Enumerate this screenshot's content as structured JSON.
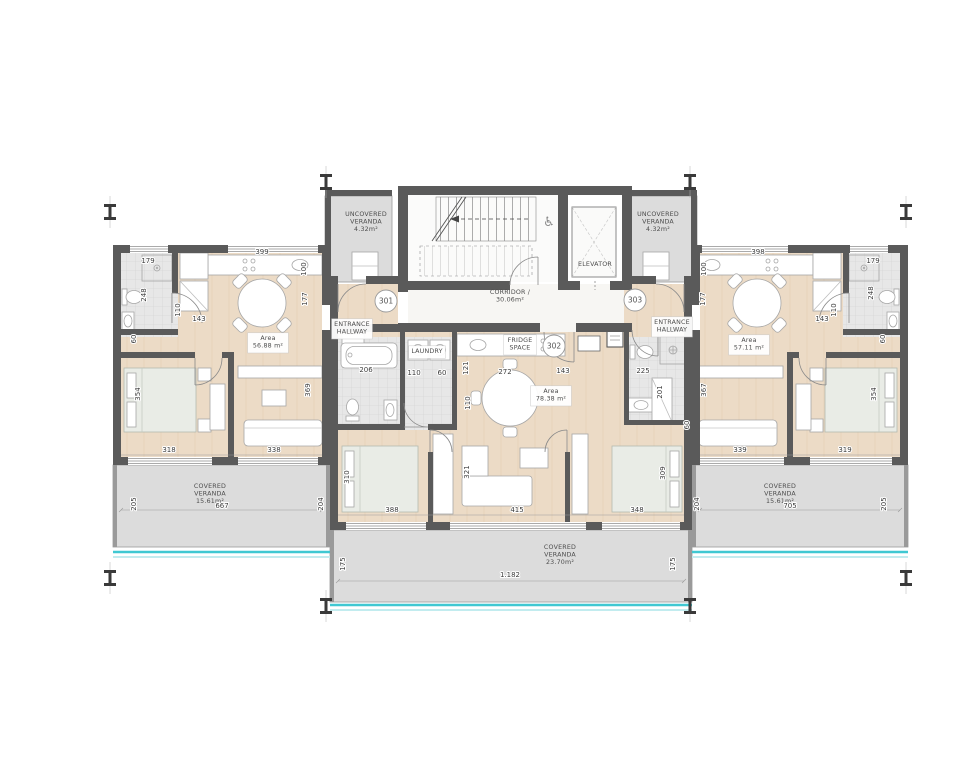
{
  "plan": {
    "drawing": "apartment-floor-plan",
    "icons": {
      "wheelchair": "♿"
    },
    "colors": {
      "wall": "#5a5a5a",
      "wood_floor": "#ecdbc6",
      "tile": "#e8e8e8",
      "veranda_slab": "#dcdcdc",
      "pool_edge_teal": "#3fc8d2",
      "pool_edge_light": "#c2ecef",
      "bed": "#e9ece6",
      "furniture": "#ffffff"
    },
    "units": [
      {
        "number": "301",
        "x": 386,
        "y": 301
      },
      {
        "number": "302",
        "x": 554,
        "y": 346
      },
      {
        "number": "303",
        "x": 635,
        "y": 300
      }
    ],
    "rooms": [
      {
        "name": "uncovered-veranda-left",
        "lines": [
          "UNCOVERED",
          "VERANDA",
          "4.32m²"
        ],
        "x": 366,
        "y": 216
      },
      {
        "name": "uncovered-veranda-right",
        "lines": [
          "UNCOVERED",
          "VERANDA",
          "4.32m²"
        ],
        "x": 658,
        "y": 216
      },
      {
        "name": "corridor",
        "lines": [
          "CORRIDOR /",
          "30.06m²"
        ],
        "x": 510,
        "y": 294
      },
      {
        "name": "elevator",
        "lines": [
          "ELEVATOR"
        ],
        "x": 595,
        "y": 266
      },
      {
        "name": "apartment-301-area",
        "lines": [
          "Area",
          "56.88 m²"
        ],
        "x": 268,
        "y": 340,
        "chip": true
      },
      {
        "name": "apartment-302-area",
        "lines": [
          "Area",
          "78.38 m²"
        ],
        "x": 551,
        "y": 393,
        "chip": true
      },
      {
        "name": "apartment-303-area",
        "lines": [
          "Area",
          "57.11 m²"
        ],
        "x": 749,
        "y": 342,
        "chip": true
      },
      {
        "name": "entrance-hallway-301",
        "lines": [
          "ENTRANCE",
          "HALLWAY"
        ],
        "x": 352,
        "y": 326,
        "chip": true
      },
      {
        "name": "entrance-hallway-303",
        "lines": [
          "ENTRANCE",
          "HALLWAY"
        ],
        "x": 672,
        "y": 324,
        "chip": true
      },
      {
        "name": "laundry",
        "lines": [
          "LAUNDRY"
        ],
        "x": 427,
        "y": 353,
        "chip": true
      },
      {
        "name": "fridge-space",
        "lines": [
          "FRIDGE",
          "SPACE"
        ],
        "x": 520,
        "y": 342,
        "chip": true
      },
      {
        "name": "covered-veranda-left",
        "lines": [
          "COVERED",
          "VERANDA",
          "15.61m²"
        ],
        "x": 210,
        "y": 488
      },
      {
        "name": "covered-veranda-middle",
        "lines": [
          "COVERED",
          "VERANDA",
          "23.70m²"
        ],
        "x": 560,
        "y": 549
      },
      {
        "name": "covered-veranda-right",
        "lines": [
          "COVERED",
          "VERANDA",
          "15.61m²"
        ],
        "x": 780,
        "y": 488
      }
    ],
    "dimensions": [
      {
        "t": "399",
        "x": 262,
        "y": 254
      },
      {
        "t": "179",
        "x": 148,
        "y": 263
      },
      {
        "t": "248",
        "x": 146,
        "y": 295,
        "v": 1
      },
      {
        "t": "110",
        "x": 180,
        "y": 310,
        "v": 1
      },
      {
        "t": "143",
        "x": 199,
        "y": 321
      },
      {
        "t": "60",
        "x": 136,
        "y": 339,
        "v": 1
      },
      {
        "t": "100",
        "x": 306,
        "y": 269,
        "v": 1
      },
      {
        "t": "177",
        "x": 307,
        "y": 299,
        "v": 1
      },
      {
        "t": "354",
        "x": 140,
        "y": 394,
        "v": 1
      },
      {
        "t": "369",
        "x": 310,
        "y": 390,
        "v": 1
      },
      {
        "t": "318",
        "x": 169,
        "y": 452
      },
      {
        "t": "338",
        "x": 274,
        "y": 452
      },
      {
        "t": "205",
        "x": 136,
        "y": 504,
        "v": 1
      },
      {
        "t": "204",
        "x": 323,
        "y": 504,
        "v": 1
      },
      {
        "t": "667",
        "x": 222,
        "y": 508
      },
      {
        "t": "206",
        "x": 366,
        "y": 372
      },
      {
        "t": "110",
        "x": 414,
        "y": 375
      },
      {
        "t": "60",
        "x": 442,
        "y": 375
      },
      {
        "t": "121",
        "x": 468,
        "y": 368,
        "v": 1
      },
      {
        "t": "272",
        "x": 505,
        "y": 374
      },
      {
        "t": "143",
        "x": 563,
        "y": 373
      },
      {
        "t": "225",
        "x": 643,
        "y": 373
      },
      {
        "t": "110",
        "x": 470,
        "y": 403,
        "v": 1
      },
      {
        "t": "201",
        "x": 662,
        "y": 392,
        "v": 1
      },
      {
        "t": "60",
        "x": 689,
        "y": 425,
        "v": 1
      },
      {
        "t": "310",
        "x": 349,
        "y": 477,
        "v": 1
      },
      {
        "t": "321",
        "x": 469,
        "y": 472,
        "v": 1
      },
      {
        "t": "309",
        "x": 665,
        "y": 473,
        "v": 1
      },
      {
        "t": "388",
        "x": 392,
        "y": 512
      },
      {
        "t": "415",
        "x": 517,
        "y": 512
      },
      {
        "t": "348",
        "x": 637,
        "y": 512
      },
      {
        "t": "175",
        "x": 345,
        "y": 564,
        "v": 1
      },
      {
        "t": "175",
        "x": 675,
        "y": 564,
        "v": 1
      },
      {
        "t": "1.182",
        "x": 510,
        "y": 577
      },
      {
        "t": "398",
        "x": 758,
        "y": 254
      },
      {
        "t": "179",
        "x": 873,
        "y": 263
      },
      {
        "t": "248",
        "x": 873,
        "y": 293,
        "v": 1
      },
      {
        "t": "110",
        "x": 836,
        "y": 310,
        "v": 1
      },
      {
        "t": "143",
        "x": 822,
        "y": 321
      },
      {
        "t": "60",
        "x": 885,
        "y": 339,
        "v": 1
      },
      {
        "t": "100",
        "x": 706,
        "y": 269,
        "v": 1
      },
      {
        "t": "177",
        "x": 705,
        "y": 299,
        "v": 1
      },
      {
        "t": "367",
        "x": 706,
        "y": 390,
        "v": 1
      },
      {
        "t": "354",
        "x": 876,
        "y": 394,
        "v": 1
      },
      {
        "t": "339",
        "x": 740,
        "y": 452
      },
      {
        "t": "319",
        "x": 845,
        "y": 452
      },
      {
        "t": "204",
        "x": 699,
        "y": 504,
        "v": 1
      },
      {
        "t": "205",
        "x": 886,
        "y": 504,
        "v": 1
      },
      {
        "t": "705",
        "x": 790,
        "y": 508
      }
    ]
  }
}
